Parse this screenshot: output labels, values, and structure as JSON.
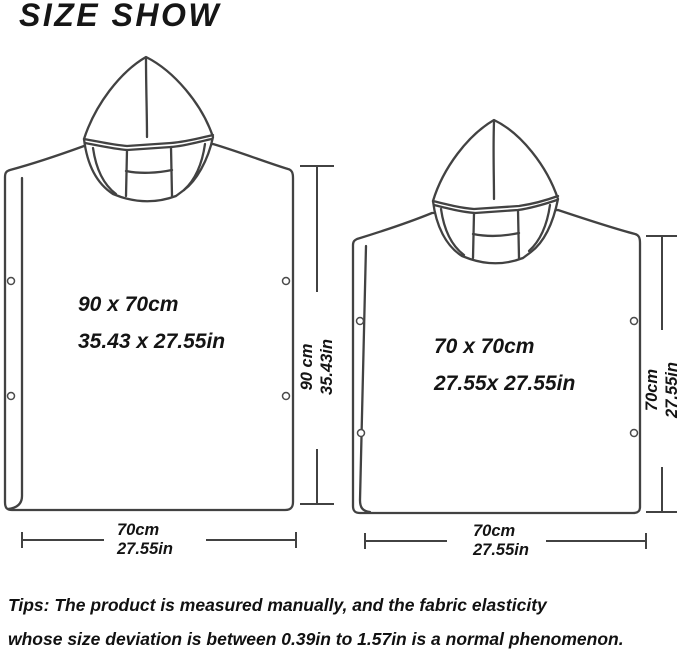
{
  "title": "SIZE SHOW",
  "ponchos": {
    "large": {
      "label_cm": "90 x 70cm",
      "label_in": "35.43 x 27.55in",
      "height": {
        "cm": "90 cm",
        "in": "35.43in"
      },
      "width": {
        "cm": "70cm",
        "in": "27.55in"
      }
    },
    "small": {
      "label_cm": "70 x 70cm",
      "label_in": "27.55x 27.55in",
      "height": {
        "cm": "70cm",
        "in": "27.55in"
      },
      "width": {
        "cm": "70cm",
        "in": "27.55in"
      }
    }
  },
  "tips": {
    "line1": "Tips: The product is measured manually, and the fabric elasticity",
    "line2": "whose size deviation is between 0.39in to 1.57in is a normal phenomenon."
  },
  "colors": {
    "line": "#424242",
    "text": "#111111",
    "background": "#ffffff"
  }
}
